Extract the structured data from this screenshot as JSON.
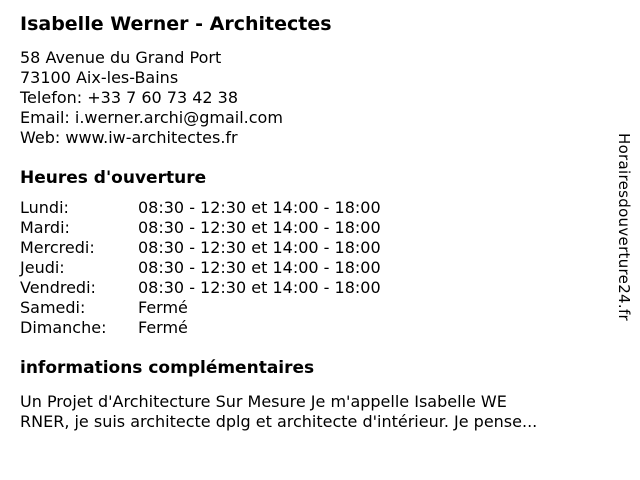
{
  "header": {
    "title": "Isabelle Werner - Architectes"
  },
  "contact": {
    "lines": [
      "58 Avenue du Grand Port",
      "73100 Aix-les-Bains",
      "Telefon: +33 7 60 73 42 38",
      "Email: i.werner.archi@gmail.com",
      "Web: www.iw-architectes.fr"
    ]
  },
  "hours": {
    "heading": "Heures d'ouverture",
    "rows": [
      {
        "day": "Lundi:",
        "value": "08:30 - 12:30 et 14:00 - 18:00"
      },
      {
        "day": "Mardi:",
        "value": "08:30 - 12:30 et 14:00 - 18:00"
      },
      {
        "day": "Mercredi:",
        "value": "08:30 - 12:30 et 14:00 - 18:00"
      },
      {
        "day": "Jeudi:",
        "value": "08:30 - 12:30 et 14:00 - 18:00"
      },
      {
        "day": "Vendredi:",
        "value": "08:30 - 12:30 et 14:00 - 18:00"
      },
      {
        "day": "Samedi:",
        "value": "Fermé"
      },
      {
        "day": "Dimanche:",
        "value": "Fermé"
      }
    ]
  },
  "info": {
    "heading": "informations complémentaires",
    "lines": [
      "Un Projet d'Architecture Sur Mesure Je m'appelle Isabelle WE",
      "RNER, je suis architecte dplg et architecte d'intérieur. Je pense..."
    ]
  },
  "watermark": {
    "text": "Horairesdouverture24.fr"
  },
  "colors": {
    "background": "#ffffff",
    "text": "#000000"
  }
}
